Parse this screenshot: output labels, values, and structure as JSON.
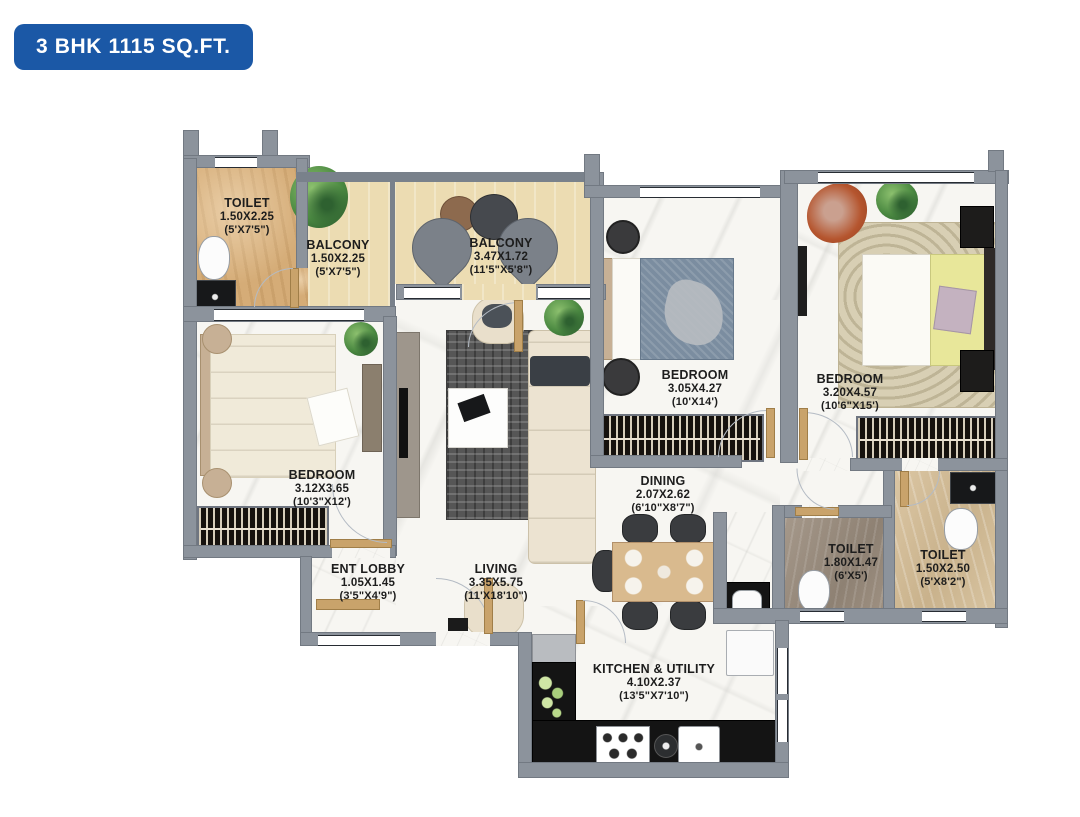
{
  "title_badge": "3 BHK 1115 SQ.FT.",
  "plan_type": "floor-plan",
  "colors": {
    "badge_blue": "#1b58a6",
    "wall_grey": "#8c939c",
    "floor_marble_white": "#f7f6f2",
    "balcony_cream": "#ecdcb2",
    "toilet_tan": "#d5ac77",
    "toilet_stone": "#988b7d",
    "toilet_beige": "#d2bd99",
    "counter_black": "#141414",
    "door_wood": "#c9a36b",
    "label_text": "#1d1d1d"
  },
  "rooms": [
    {
      "name": "TOILET",
      "metric": "1.50X2.25",
      "imperial": "(5'X7'5\")"
    },
    {
      "name": "BALCONY",
      "metric": "1.50X2.25",
      "imperial": "(5'X7'5\")"
    },
    {
      "name": "BALCONY",
      "metric": "3.47X1.72",
      "imperial": "(11'5\"X5'8\")"
    },
    {
      "name": "BEDROOM",
      "metric": "3.05X4.27",
      "imperial": "(10'X14')"
    },
    {
      "name": "BEDROOM",
      "metric": "3.20X4.57",
      "imperial": "(10'6\"X15')"
    },
    {
      "name": "BEDROOM",
      "metric": "3.12X3.65",
      "imperial": "(10'3\"X12')"
    },
    {
      "name": "ENT LOBBY",
      "metric": "1.05X1.45",
      "imperial": "(3'5\"X4'9\")"
    },
    {
      "name": "LIVING",
      "metric": "3.35X5.75",
      "imperial": "(11'X18'10\")"
    },
    {
      "name": "DINING",
      "metric": "2.07X2.62",
      "imperial": "(6'10\"X8'7\")"
    },
    {
      "name": "TOILET",
      "metric": "1.80X1.47",
      "imperial": "(6'X5')"
    },
    {
      "name": "TOILET",
      "metric": "1.50X2.50",
      "imperial": "(5'X8'2\")"
    },
    {
      "name": "KITCHEN & UTILITY",
      "metric": "4.10X2.37",
      "imperial": "(13'5\"X7'10\")"
    }
  ]
}
